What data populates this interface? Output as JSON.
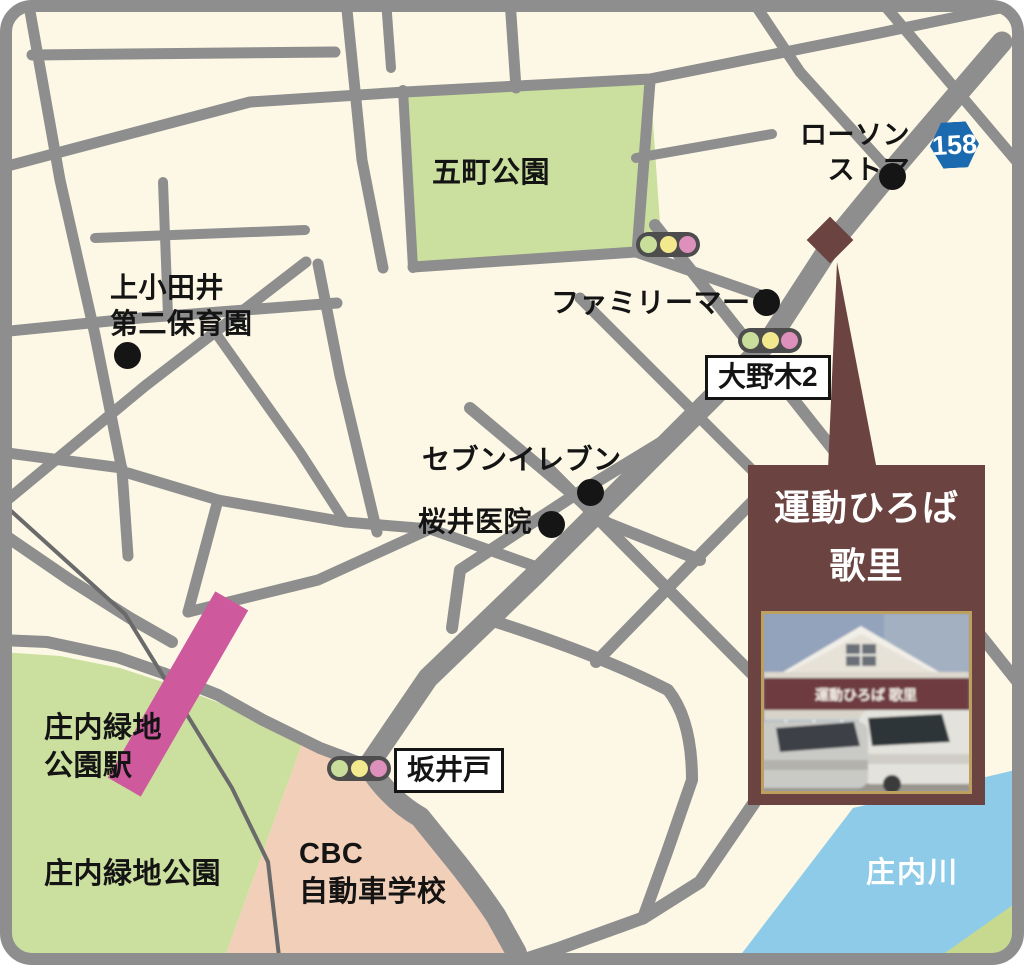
{
  "places": {
    "lawson": "ローソン\nストア",
    "gocho_park": "五町公園",
    "kamiotai_hoikuen": "上小田井\n第二保育園",
    "familymart": "ファミリーマート",
    "seven_eleven": "セブンイレブン",
    "sakurai_clinic": "桜井医院",
    "shonai_ryokuchi_station": "庄内緑地\n公園駅",
    "shonai_ryokuchi_park": "庄内緑地公園",
    "cbc_driving_school": "CBC\n自動車学校",
    "shonai_river": "庄内川"
  },
  "intersections": {
    "onogi": "大野木2",
    "sakaido": "坂井戸"
  },
  "route_badge": {
    "number": "158",
    "color": "#1b69ae"
  },
  "destination": {
    "line1": "運動ひろば",
    "line2": "歌里",
    "title": "運動ひろば\n歌里",
    "photo_sign": "運動ひろば 歌里",
    "panel_color": "#6b4442"
  },
  "colors": {
    "background": "#fcf8e5",
    "road": "#8e8e8e",
    "railway": "#6a6a6a",
    "park_green": "#cbdf9f",
    "driving_school": "#f2cfb8",
    "river_blue": "#8ecbe9",
    "station_pink": "#ce5a9d",
    "signal_green": "#c9de9b",
    "signal_yellow": "#f2e88d",
    "signal_pink": "#dd90bb",
    "poi_dot": "#151515"
  }
}
